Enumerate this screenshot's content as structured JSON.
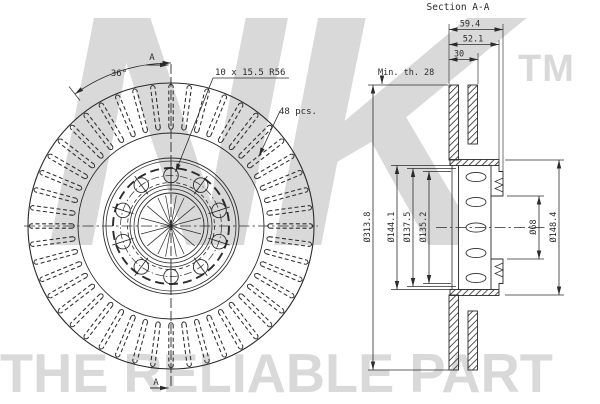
{
  "drawing": {
    "front_view": {
      "angle_label": "36°",
      "holes_label": "10 x 15.5 R56",
      "vanes_label": "48 pcs.",
      "section_letter_top": "A",
      "section_letter_bottom": "A",
      "vane_count": 48,
      "bolt_hole_count": 10
    },
    "section_view": {
      "title": "Section A-A",
      "dim_total_height": "59.4",
      "dim_hub_height": "52.1",
      "dim_disc_thickness": "30",
      "dim_min_thickness": "Min. th. 28",
      "dim_outer_diameter": "Ø313.8",
      "dim_bell_outer": "Ø144.1",
      "dim_bell_mid": "Ø137.5",
      "dim_bell_inner": "Ø135.2",
      "dim_bore": "Ø68",
      "dim_hub_flange": "Ø148.4"
    }
  },
  "watermark": {
    "brand": "NK",
    "trademark": "TM",
    "tagline": "THE RELIABLE PART"
  },
  "colors": {
    "line": "#2b2b2b",
    "watermark_gray": "#d9d9d9",
    "background": "#ffffff"
  }
}
